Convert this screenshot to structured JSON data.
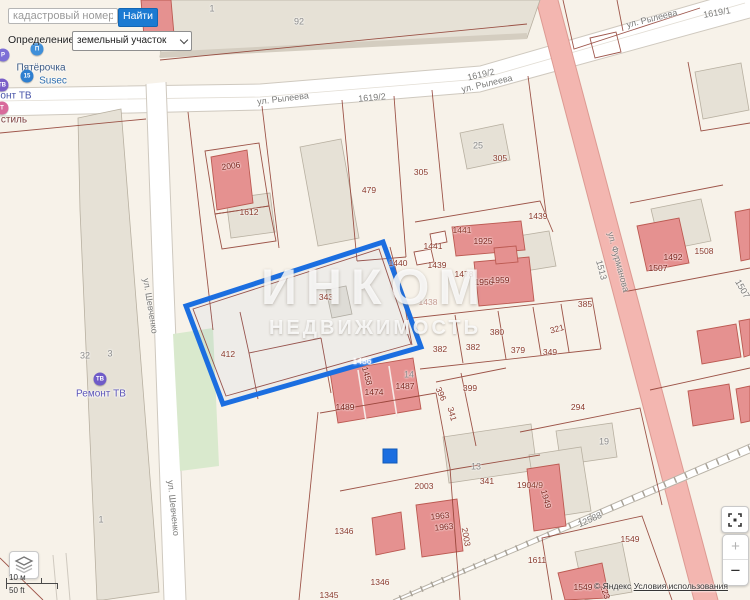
{
  "search": {
    "placeholder": "кадастровый номер",
    "button_label": "Найти"
  },
  "filter": {
    "label": "Определение:",
    "value": "земельный участок"
  },
  "watermark": {
    "line1": "ИНКОМ",
    "line2": "НЕДВИЖИМОСТЬ"
  },
  "scale": {
    "metric": "10 м",
    "imperial": "50 ft"
  },
  "attribution": {
    "copyright": "© Яндекс",
    "terms_link": "Условия использования"
  },
  "map_controls": {
    "zoom_in": "+",
    "zoom_out": "−"
  },
  "colors": {
    "background": "#f7f2e9",
    "parcel_line": "#8e3a2e",
    "road_white": "#ffffff",
    "road_pink": "#f3b6b0",
    "building_gray": "#e6e1d6",
    "building_red": "#e59190",
    "highlight_blue": "#1b6ee0",
    "green_area": "#d9e9cd",
    "watermark_white": "rgba(255,255,255,0.82)",
    "button_blue": "#1b7ad2"
  },
  "pois": [
    {
      "name": "parking",
      "label": "",
      "icon_x": 3,
      "icon_y": 55,
      "icon_color": "#7d6fd6",
      "glyph": "P",
      "label_x": 0,
      "label_y": 0,
      "label_color": "#555"
    },
    {
      "name": "pyaterochka",
      "label": "Пятёрочка",
      "icon_x": 37,
      "icon_y": 49,
      "icon_color": "#3f8fd9",
      "glyph": "П",
      "label_x": 41,
      "label_y": 68,
      "label_color": "#3b5a85"
    },
    {
      "name": "susec",
      "label": "Susec",
      "icon_x": 27,
      "icon_y": 76,
      "icon_color": "#2f7fd0",
      "glyph": "15",
      "label_x": 53,
      "label_y": 81,
      "label_color": "#2f6fb0"
    },
    {
      "name": "remont-tv-cut",
      "label": "онт ТВ",
      "icon_x": 2,
      "icon_y": 85,
      "icon_color": "#7a5fc8",
      "glyph": "ТВ",
      "label_x": 16,
      "label_y": 96,
      "label_color": "#4653a8"
    },
    {
      "name": "textile-cut",
      "label": "стиль",
      "icon_x": 2,
      "icon_y": 108,
      "icon_color": "#d86a9c",
      "glyph": "Т",
      "label_x": 14,
      "label_y": 120,
      "label_color": "#7d4040"
    },
    {
      "name": "remont-tv",
      "label": "Ремонт ТВ",
      "icon_x": 100,
      "icon_y": 379,
      "icon_color": "#6f5bc8",
      "glyph": "ТВ",
      "label_x": 101,
      "label_y": 394,
      "label_color": "#5b54b8"
    }
  ],
  "street_labels": [
    {
      "text": "ул. Рылеева",
      "x": 283,
      "y": 99,
      "rot": -7
    },
    {
      "text": "1619/2",
      "x": 372,
      "y": 98,
      "rot": -5
    },
    {
      "text": "ул. Рылеева",
      "x": 487,
      "y": 84,
      "rot": -13
    },
    {
      "text": "1619/2",
      "x": 481,
      "y": 75,
      "rot": -13
    },
    {
      "text": "ул. Рылеева",
      "x": 652,
      "y": 19,
      "rot": -14
    },
    {
      "text": "1619/1",
      "x": 717,
      "y": 13,
      "rot": -10
    },
    {
      "text": "ул. Шевченко",
      "x": 150,
      "y": 306,
      "rot": 81
    },
    {
      "text": "ул. Шевченко",
      "x": 173,
      "y": 508,
      "rot": 84
    },
    {
      "text": "ул. Фурманова",
      "x": 618,
      "y": 262,
      "rot": 75
    },
    {
      "text": "1513",
      "x": 601,
      "y": 270,
      "rot": 75
    },
    {
      "text": "1507",
      "x": 742,
      "y": 289,
      "rot": 60
    },
    {
      "text": "12588",
      "x": 590,
      "y": 520,
      "rot": -24
    }
  ],
  "parcel_labels": [
    {
      "text": "2006",
      "x": 231,
      "y": 166,
      "rot": -8,
      "color": "#7c241c"
    },
    {
      "text": "1612",
      "x": 249,
      "y": 212
    },
    {
      "text": "479",
      "x": 369,
      "y": 190
    },
    {
      "text": "305",
      "x": 421,
      "y": 172
    },
    {
      "text": "305",
      "x": 500,
      "y": 158
    },
    {
      "text": "1441",
      "x": 462,
      "y": 230
    },
    {
      "text": "1441",
      "x": 433,
      "y": 246
    },
    {
      "text": "1440",
      "x": 398,
      "y": 263
    },
    {
      "text": "1439",
      "x": 437,
      "y": 265
    },
    {
      "text": "1439",
      "x": 538,
      "y": 216
    },
    {
      "text": "1478",
      "x": 464,
      "y": 274
    },
    {
      "text": "1925",
      "x": 483,
      "y": 241,
      "color": "#7c241c"
    },
    {
      "text": "1956",
      "x": 484,
      "y": 282,
      "color": "#7c241c"
    },
    {
      "text": "1959",
      "x": 500,
      "y": 280,
      "color": "#7c241c"
    },
    {
      "text": "1438",
      "x": 428,
      "y": 302,
      "color": "#c49a90"
    },
    {
      "text": "385",
      "x": 585,
      "y": 304
    },
    {
      "text": "380",
      "x": 497,
      "y": 332
    },
    {
      "text": "382",
      "x": 440,
      "y": 349
    },
    {
      "text": "382",
      "x": 473,
      "y": 347
    },
    {
      "text": "379",
      "x": 518,
      "y": 350
    },
    {
      "text": "349",
      "x": 550,
      "y": 352
    },
    {
      "text": "321",
      "x": 557,
      "y": 329,
      "rot": -15
    },
    {
      "text": "343",
      "x": 326,
      "y": 297
    },
    {
      "text": "412",
      "x": 228,
      "y": 354
    },
    {
      "text": "1486",
      "x": 362,
      "y": 361,
      "color": "#ffffff"
    },
    {
      "text": "1489",
      "x": 345,
      "y": 407,
      "color": "#7c241c"
    },
    {
      "text": "1474",
      "x": 374,
      "y": 392,
      "color": "#7c241c"
    },
    {
      "text": "1487",
      "x": 405,
      "y": 386,
      "color": "#7c241c"
    },
    {
      "text": "1458",
      "x": 367,
      "y": 376,
      "rot": 75,
      "color": "#7c241c"
    },
    {
      "text": "396",
      "x": 441,
      "y": 394,
      "rot": 65
    },
    {
      "text": "399",
      "x": 470,
      "y": 388
    },
    {
      "text": "341",
      "x": 452,
      "y": 414,
      "rot": 75
    },
    {
      "text": "341",
      "x": 487,
      "y": 481
    },
    {
      "text": "294",
      "x": 578,
      "y": 407
    },
    {
      "text": "2003",
      "x": 424,
      "y": 486
    },
    {
      "text": "2003",
      "x": 466,
      "y": 537,
      "rot": 80
    },
    {
      "text": "1904/9",
      "x": 530,
      "y": 485
    },
    {
      "text": "1949",
      "x": 546,
      "y": 499,
      "rot": 75,
      "color": "#7c241c"
    },
    {
      "text": "1963",
      "x": 440,
      "y": 516,
      "rot": -6,
      "color": "#7c241c"
    },
    {
      "text": "1963",
      "x": 444,
      "y": 527,
      "rot": -6,
      "color": "#7c241c"
    },
    {
      "text": "1346",
      "x": 344,
      "y": 531
    },
    {
      "text": "1346",
      "x": 380,
      "y": 582
    },
    {
      "text": "1345",
      "x": 329,
      "y": 595
    },
    {
      "text": "1611",
      "x": 537,
      "y": 560
    },
    {
      "text": "1549",
      "x": 630,
      "y": 539
    },
    {
      "text": "1549",
      "x": 583,
      "y": 587,
      "color": "#7c241c"
    },
    {
      "text": "223",
      "x": 605,
      "y": 592,
      "rot": 70,
      "color": "#7c241c"
    },
    {
      "text": "1508",
      "x": 704,
      "y": 251
    },
    {
      "text": "1492",
      "x": 673,
      "y": 257,
      "color": "#7c241c"
    },
    {
      "text": "1507",
      "x": 658,
      "y": 268,
      "color": "#7c241c"
    }
  ],
  "address_labels": [
    {
      "text": "92",
      "x": 299,
      "y": 22
    },
    {
      "text": "1",
      "x": 212,
      "y": 9
    },
    {
      "text": "25",
      "x": 478,
      "y": 146
    },
    {
      "text": "32",
      "x": 85,
      "y": 356
    },
    {
      "text": "3",
      "x": 110,
      "y": 354
    },
    {
      "text": "14",
      "x": 409,
      "y": 375
    },
    {
      "text": "13",
      "x": 476,
      "y": 467
    },
    {
      "text": "19",
      "x": 604,
      "y": 442
    },
    {
      "text": "1",
      "x": 101,
      "y": 520
    }
  ],
  "signs": [
    {
      "text": "КС",
      "x": 741,
      "y": 582,
      "color": "#d63a32",
      "size": 11
    }
  ]
}
